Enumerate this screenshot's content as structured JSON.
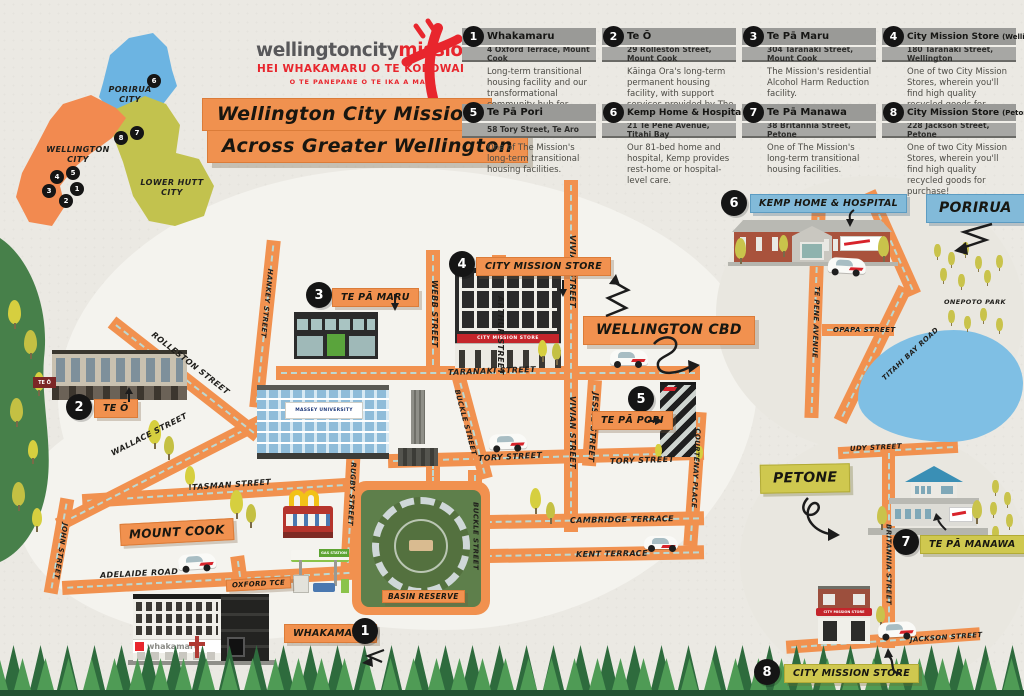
{
  "poster": {
    "logo": {
      "brand_gray": "wellingtoncity",
      "brand_red": "mission",
      "tagline_1": "HEI WHAKAMARU O TE KOROWAI",
      "tagline_2": "O TE PANEPANE O TE IKA A MAUI"
    },
    "title": {
      "line1": "Wellington City Mission",
      "line2": "Across Greater Wellington"
    }
  },
  "region_map": {
    "porirua_label": "PORIRUA\nCITY",
    "wellington_label": "WELLINGTON\nCITY",
    "lower_hutt_label": "LOWER HUTT\nCITY"
  },
  "legend": [
    {
      "number": "1",
      "name": "Whakamaru",
      "suffix": "",
      "address": "4 Oxford Terrace, Mount Cook",
      "description": "Long-term transitional housing facility and our transformational community hub for Wellington."
    },
    {
      "number": "2",
      "name": "Te Ō",
      "suffix": "",
      "address": "29 Rolleston Street, Mount Cook",
      "description": "Kāinga Ora's long-term permanent housing facility, with support services provided by The Mission."
    },
    {
      "number": "3",
      "name": "Te Pā Maru",
      "suffix": "",
      "address": "304 Taranaki Street, Mount Cook",
      "description": "The Mission's residential Alcohol Harm Reduction facility."
    },
    {
      "number": "4",
      "name": "City Mission Store",
      "suffix": "(Wellington)",
      "address": "180 Taranaki Street, Wellington",
      "description": "One of two City Mission Stores, wherein you'll find high quality recycled goods for purchase!"
    },
    {
      "number": "5",
      "name": "Te Pā Pori",
      "suffix": "",
      "address": "58 Tory Street, Te Aro",
      "description": "One of The Mission's long-term transitional housing facilities."
    },
    {
      "number": "6",
      "name": "Kemp Home & Hospital",
      "suffix": "",
      "address": "21 Te Pene Avenue, Titahi Bay",
      "description": "Our 81-bed home and hospital, Kemp provides rest-home or hospital-level care."
    },
    {
      "number": "7",
      "name": "Te Pā Manawa",
      "suffix": "",
      "address": "38 Britannia Street, Petone",
      "description": "One of The Mission's long-term transitional housing facilities."
    },
    {
      "number": "8",
      "name": "City Mission Store",
      "suffix": "(Petone)",
      "address": "228 Jackson Street, Petone",
      "description": "One of two City Mission Stores, wherein you'll find high quality recycled goods for purchase!"
    }
  ],
  "map": {
    "locations": [
      {
        "number": "1",
        "label": "WHAKAMARU"
      },
      {
        "number": "2",
        "label": "TE Ō"
      },
      {
        "number": "3",
        "label": "TE PĀ MARU"
      },
      {
        "number": "4",
        "label": "CITY MISSION STORE"
      },
      {
        "number": "5",
        "label": "TE PĀ PORI"
      },
      {
        "number": "6",
        "label": "KEMP HOME & HOSPITAL"
      },
      {
        "number": "7",
        "label": "TE PĀ MANAWA"
      },
      {
        "number": "8",
        "label": "CITY MISSION STORE"
      }
    ],
    "places": {
      "wellington_cbd": "WELLINGTON CBD",
      "mount_cook": "MOUNT COOK",
      "porirua": "PORIRUA",
      "petone": "PETONE",
      "basin_reserve": "BASIN RESERVE",
      "onepoto_park": "ONEPOTO PARK"
    },
    "streets": {
      "hankey": "HANKEY STREET",
      "webb": "WEBB STREET",
      "arthur": "ARTHUR STREET",
      "vivian": "VIVIAN STREET",
      "jessie": "JESSIE STREET",
      "taranaki": "TARANAKI STREET",
      "tory": "TORY STREET",
      "courtenay": "COURTENAY PLACE",
      "cambridge": "CAMBRIDGE TERRACE",
      "kent": "KENT TERRACE",
      "buckle": "BUCKLE STREET",
      "rugby": "RUGBY STREET",
      "tasman": "TASMAN STREET",
      "wallace": "WALLACE STREET",
      "john": "JOHN STREET",
      "adelaide": "ADELAIDE ROAD",
      "oxford": "OXFORD TCE",
      "rolleston": "ROLLESTON STREET",
      "te_pene": "TE PENE AVENUE",
      "opapa": "OPAPA STREET",
      "titahi_bay": "TITAHI BAY ROAD",
      "udy": "UDY STREET",
      "britannia": "BRITANNIA STREET",
      "jackson": "JACKSON STREET"
    },
    "signs": {
      "whakamaru": "whakamaru",
      "massey": "MASSEY UNIVERSITY",
      "store_wellington": "CITY MISSION STORE",
      "store_petone": "CITY MISSION STORE",
      "gas_station": "GAS STATION",
      "te_o": "TE Ō"
    }
  },
  "colors": {
    "street_orange": "#F1914F",
    "mission_red": "#E8262D",
    "banner_blue": "#82BAD9",
    "banner_yellow": "#CFC84F",
    "badge_black": "#151515",
    "porirua_blue": "#6CB4E2",
    "wellington_orange": "#F28A50",
    "lower_hutt_olive": "#C2C24E",
    "water_blue": "#7FBFE4"
  }
}
